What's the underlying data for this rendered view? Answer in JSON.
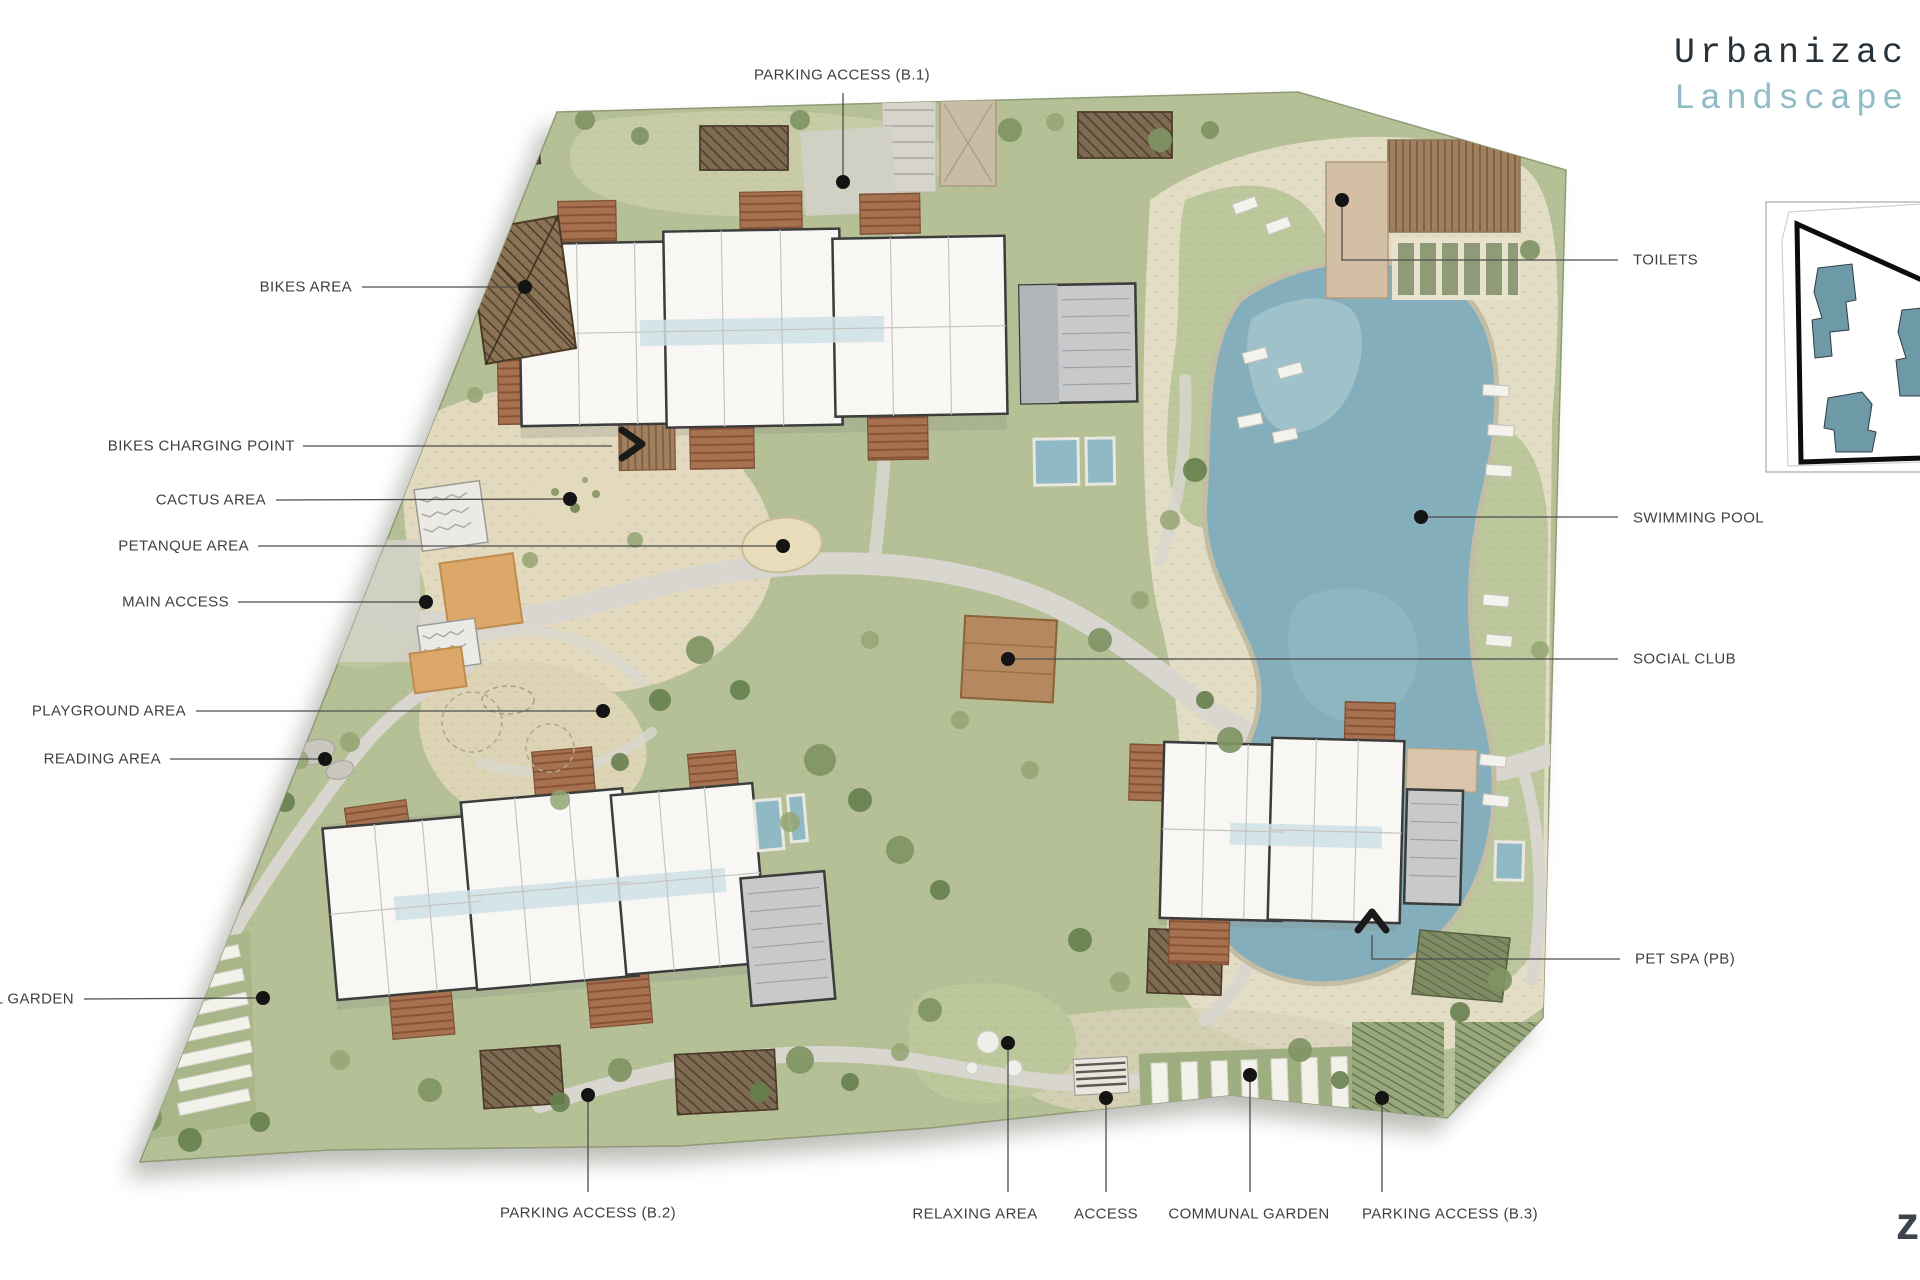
{
  "title": {
    "line1": "Urbanizac",
    "line2": "Landscape"
  },
  "callouts": {
    "parking_b1": {
      "label": "PARKING ACCESS (B.1)"
    },
    "bikes_area": {
      "label": "BIKES AREA"
    },
    "bikes_charging": {
      "label": "BIKES CHARGING POINT"
    },
    "cactus": {
      "label": "CACTUS AREA"
    },
    "petanque": {
      "label": "PETANQUE AREA"
    },
    "main_access": {
      "label": "MAIN ACCESS"
    },
    "playground": {
      "label": "PLAYGROUND AREA"
    },
    "reading": {
      "label": "READING AREA"
    },
    "garden_left": {
      "label": "L GARDEN"
    },
    "parking_b2": {
      "label": "PARKING ACCESS (B.2)"
    },
    "relaxing": {
      "label": "RELAXING AREA"
    },
    "access": {
      "label": "ACCESS"
    },
    "communal_garden": {
      "label": "COMMUNAL GARDEN"
    },
    "parking_b3": {
      "label": "PARKING ACCESS (B.3)"
    },
    "toilets": {
      "label": "TOILETS"
    },
    "swimming_pool": {
      "label": "SWIMMING POOL"
    },
    "social_club": {
      "label": "SOCIAL CLUB"
    },
    "pet_spa": {
      "label": "PET SPA (PB)"
    }
  },
  "watermark": {
    "glyph": "z"
  },
  "colors": {
    "title_dark": "#27323a",
    "title_teal": "#8fbcc6",
    "label_text": "#3e4041",
    "lawn": "#b5c096",
    "sand": "#e2d9bf",
    "path": "#d8d6ce",
    "pool_water": "#84aebb",
    "building_fill": "#f8f7f4",
    "building_line": "#3c3c3c",
    "deck_brown": "#9b7a5f",
    "terracotta": "#a5714f",
    "garage_gray": "#c7c9cb",
    "inset_building_teal": "#6e99a6",
    "leader_line": "#4d4d4d",
    "dot": "#141414"
  }
}
